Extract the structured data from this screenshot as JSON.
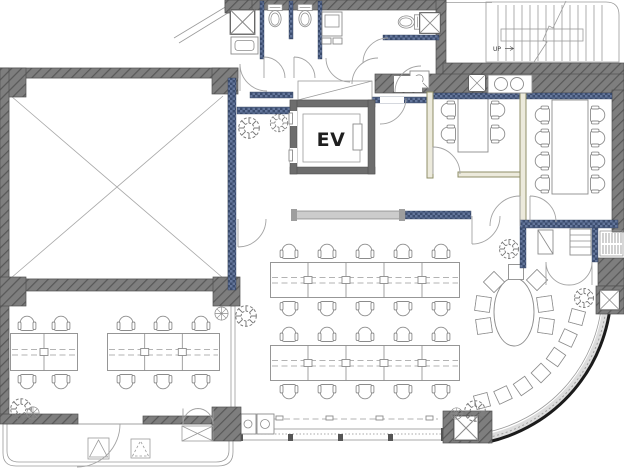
{
  "plan": {
    "type": "architectural floor plan",
    "labels": {
      "elevator": "EV",
      "stairs_direction": "UP"
    },
    "rooms": [
      "void-atrium",
      "restrooms",
      "elevator",
      "staircase",
      "meeting-room-small",
      "meeting-room-large",
      "open-office",
      "training-area",
      "lounge",
      "pantry",
      "terrace"
    ],
    "furniture": {
      "office_desk_rows": 2,
      "office_seats_per_row": 10,
      "training_desk_groups": 2,
      "training_seats": 10,
      "meeting_small_seats": 4,
      "meeting_large_seats": 8,
      "lounge_oval_seats": 7,
      "lounge_curve_stools": 7,
      "terrace_planters": 2
    },
    "colors": {
      "wall": "#7e7e7e",
      "wall_hatch": "#585858",
      "partition": "#3c4d6f",
      "partition_light": "#64769b",
      "glass_panel": "#cccccc",
      "drawing_line": "#8c8c8c",
      "facade_curve": "#1b1b1b",
      "background": "#ffffff"
    }
  }
}
